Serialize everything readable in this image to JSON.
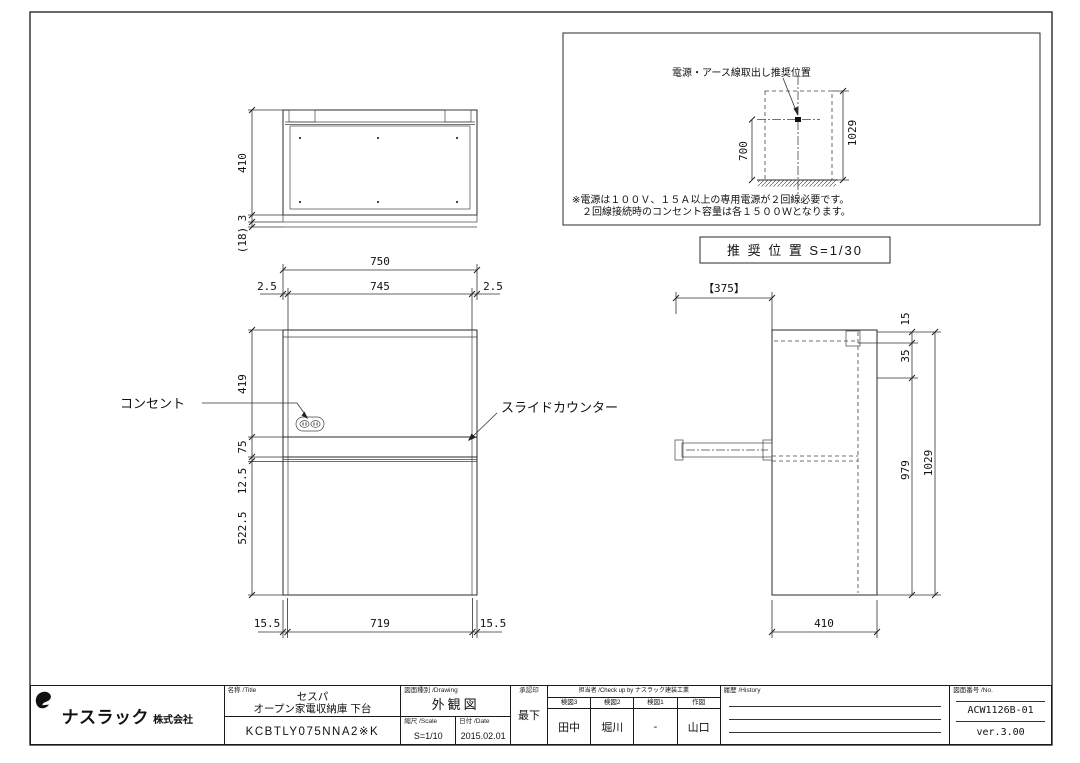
{
  "page": {
    "background": "#ffffff",
    "line_color": "#2a2a2a"
  },
  "top_view": {
    "dim_depth": "410",
    "dim_toe": "3",
    "dim_toe_total": "(18)"
  },
  "front_view": {
    "dim_total_width": "750",
    "dim_inner_width": "745",
    "dim_side_left": "2.5",
    "dim_side_right": "2.5",
    "dim_upper_height": "419",
    "dim_counter_height": "75",
    "dim_counter_gap": "12.5",
    "dim_lower_height": "522.5",
    "dim_foot_left": "15.5",
    "dim_bottom_width": "719",
    "dim_foot_right": "15.5",
    "label_outlet": "コンセント",
    "label_slide_counter": "スライドカウンター"
  },
  "side_view": {
    "dim_counter_ext": "【375】",
    "dim_top": "15",
    "dim_rail": "35",
    "dim_body_height": "979",
    "dim_total_height": "1029",
    "dim_depth": "410"
  },
  "recommend_view": {
    "title": "電源・アース線取出し推奨位置",
    "dim_outlet_height": "700",
    "dim_total_height": "1029",
    "note_line1": "※電源は１００Ｖ、１５Ａ以上の専用電源が２回線必要です。",
    "note_line2": "　２回線接続時のコンセント容量は各１５００Ｗとなります。",
    "caption": "推 奨 位 置  S=1/30"
  },
  "title_block": {
    "company_big": "ナスラック",
    "company_small": "株式会社",
    "title_label": "名称 /Title",
    "product_series": "セスパ",
    "product_name": "オープン家電収納庫 下台",
    "model": "KCBTLY075NNA2※K",
    "drawing_type_label": "図面種別 /Drawing",
    "drawing_type": "外観図",
    "scale_label": "縮尺 /Scale",
    "scale": "S=1/10",
    "date_label": "日付 /Date",
    "date": "2015.02.01",
    "stamp_label": "承認印",
    "stamp": "最下",
    "staff_header": "担当者 /Check up by ナスラック建装工業",
    "check3_label": "検図3",
    "check3": "田中",
    "check2_label": "検図2",
    "check2": "堀川",
    "check1_label": "検図1",
    "check1": "-",
    "draw_label": "作図",
    "drawer": "山口",
    "history_label": "履歴 /History",
    "drawing_no_label": "図面番号 /No.",
    "drawing_no": "ACW1126B-01",
    "version": "ver.3.00"
  }
}
